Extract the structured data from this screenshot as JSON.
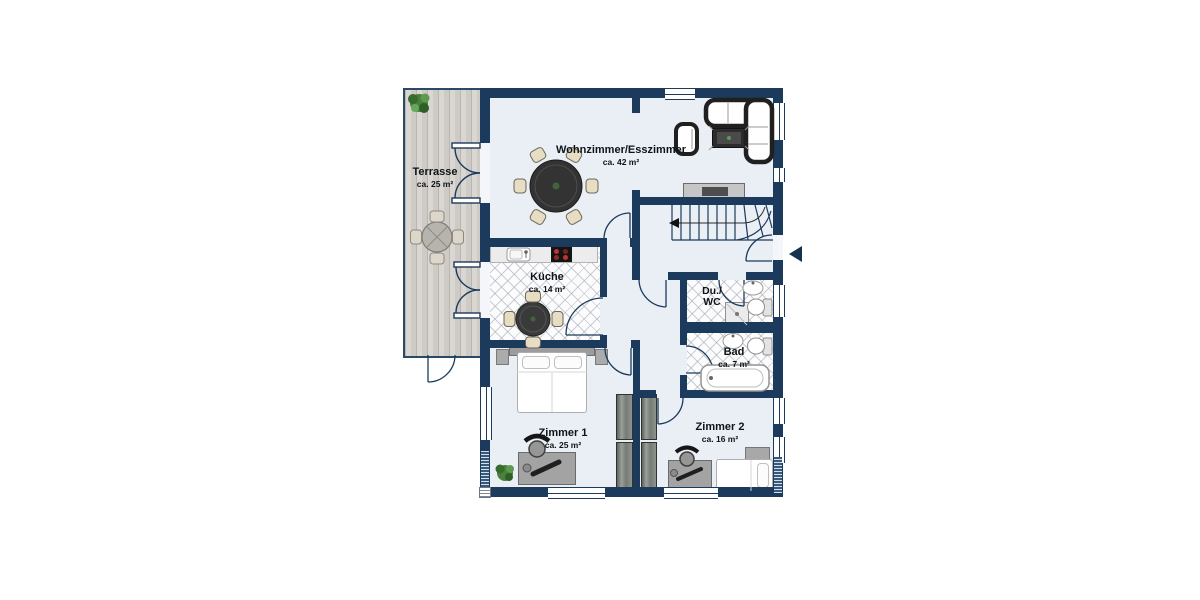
{
  "rooms": {
    "terrasse": {
      "name": "Terrasse",
      "area": "ca. 25 m²"
    },
    "wohnzimmer_esszimmer": {
      "name": "Wohnzimmer/Esszimmer",
      "area": "ca. 42 m²"
    },
    "kueche": {
      "name": "Küche",
      "area": "ca. 14 m²"
    },
    "du_wc": {
      "name_line1": "Du./",
      "name_line2": "WC"
    },
    "bad": {
      "name": "Bad",
      "area": "ca. 7 m²"
    },
    "zimmer1": {
      "name": "Zimmer 1",
      "area": "ca. 25 m²"
    },
    "zimmer2": {
      "name": "Zimmer 2",
      "area": "ca. 16 m²"
    }
  },
  "colors": {
    "wall": "#1c3a5c",
    "floor": "#eaeef5",
    "terrace_deck": "#d7d3ce",
    "tile_line": "#c7ccd6",
    "furniture_dark": "#343434",
    "chair_beige": "#e6ddc2",
    "wardrobe_gray": "#80837e",
    "plant_green": "#47813c"
  }
}
